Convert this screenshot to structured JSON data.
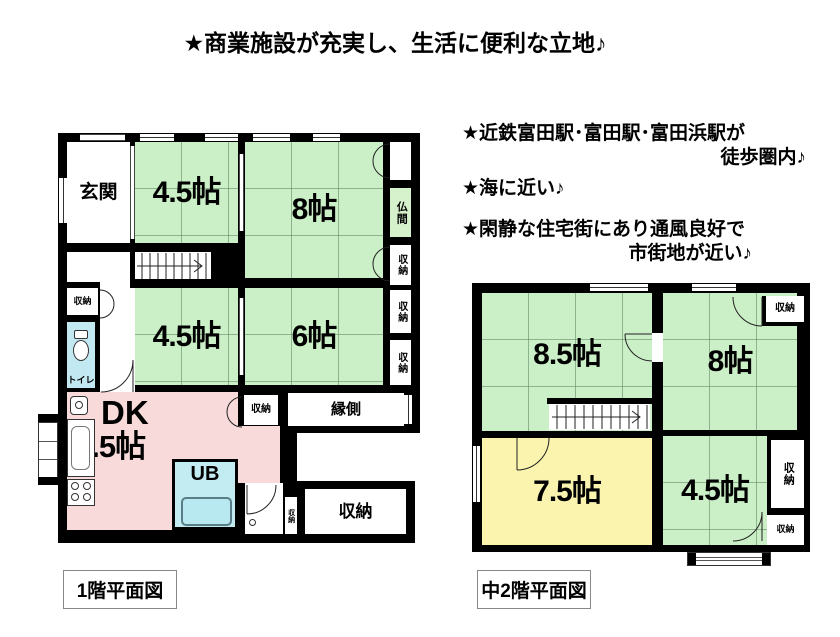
{
  "title": "★商業施設が充実し、生活に便利な立地♪",
  "notes": {
    "line1a": "★近鉄富田駅･富田駅･富田浜駅が",
    "line1b": "徒歩圏内♪",
    "line2": "★海に近い♪",
    "line3a": "★閑静な住宅街にあり通風良好で",
    "line3b": "市街地が近い♪"
  },
  "floor1": {
    "caption": "1階平面図",
    "rooms": {
      "genkan": "玄関",
      "tatami45_top": "4.5帖",
      "tatami8": "8帖",
      "butsuma": "仏間",
      "tatami45_mid": "4.5帖",
      "tatami6": "6帖",
      "toilet": "トイレ",
      "dk_line1": "DK",
      "dk_line2": "9.5帖",
      "ub": "UB",
      "engawa": "縁側",
      "storage": "収納"
    }
  },
  "floor2": {
    "caption": "中2階平面図",
    "rooms": {
      "tatami85": "8.5帖",
      "tatami8": "8帖",
      "tatami75": "7.5帖",
      "tatami45": "4.5帖",
      "storage": "収納"
    }
  },
  "colors": {
    "wall": "#000000",
    "tatami_green": "#cbefc6",
    "dk_pink": "#f8dada",
    "bath_cyan": "#c3ecf2",
    "toilet_blue": "#c2e9f2",
    "room_yellow": "#faf4ae"
  }
}
